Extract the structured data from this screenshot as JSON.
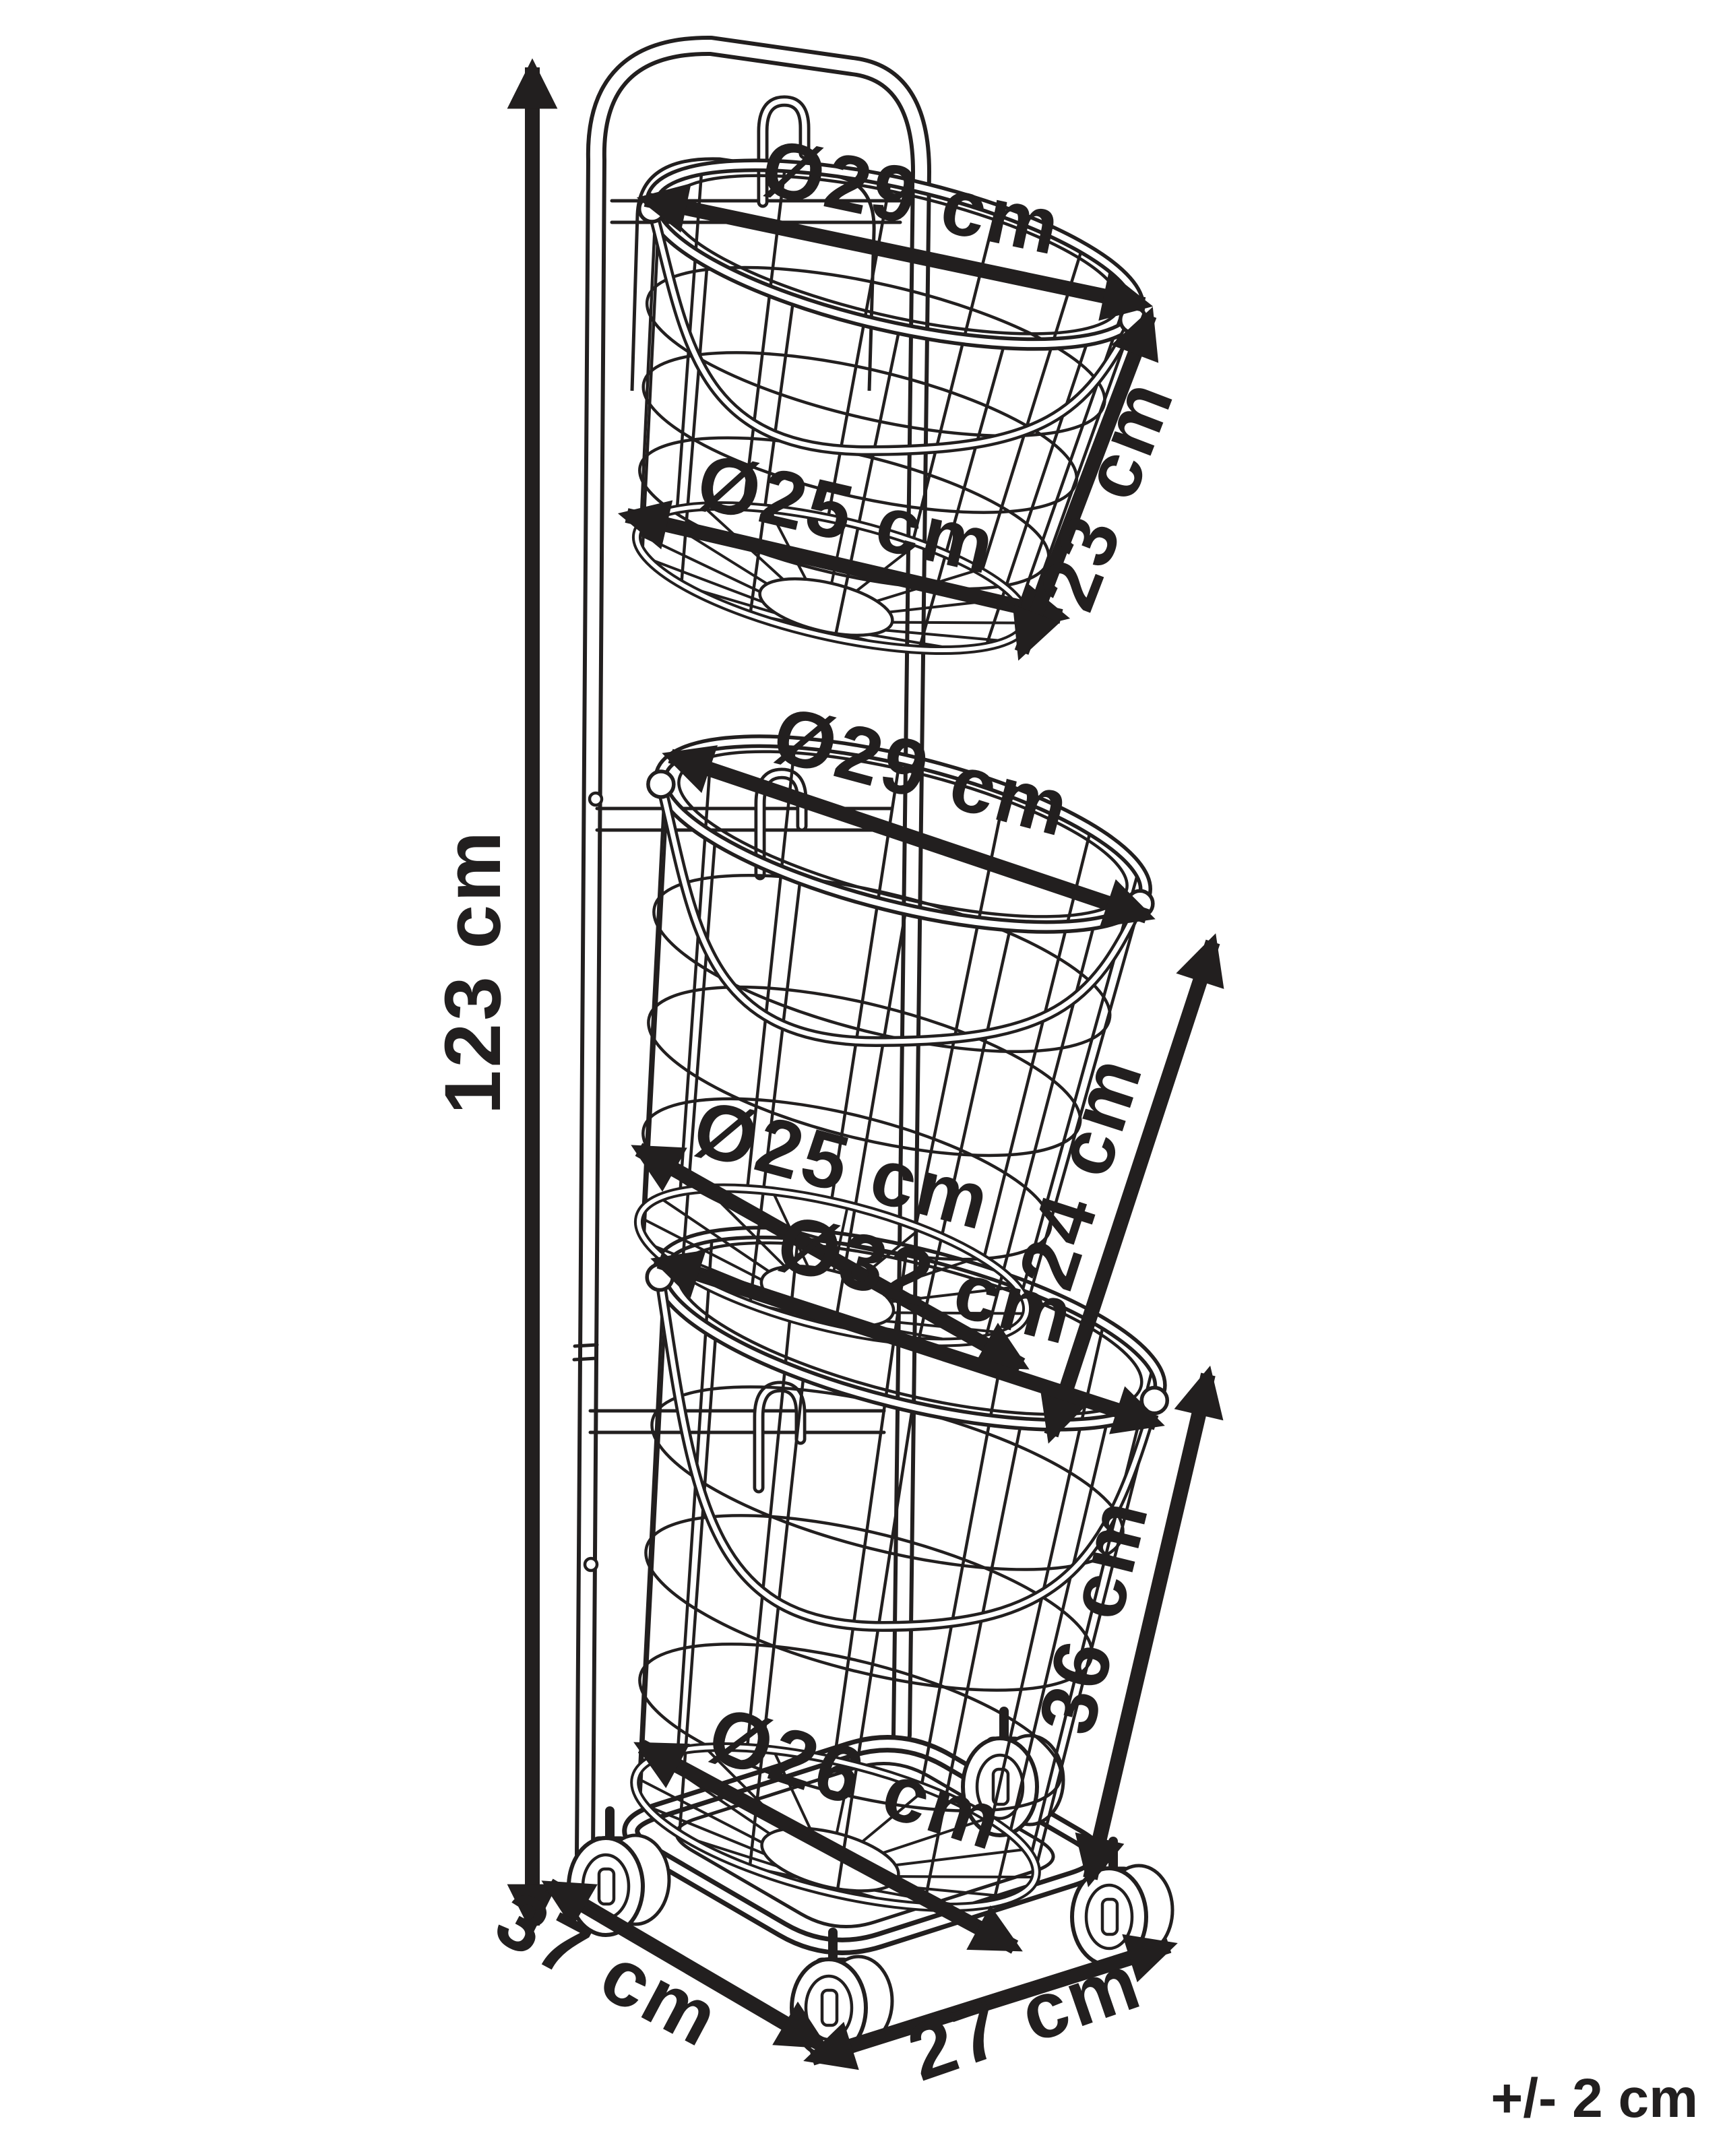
{
  "colors": {
    "background": "#ffffff",
    "ink": "#221f1f"
  },
  "labels": {
    "overall_height": "123 cm",
    "tolerance": "+/- 2 cm",
    "base": {
      "depth": "37 cm",
      "width": "27 cm"
    },
    "baskets": [
      {
        "position": "top",
        "top_diameter": "Ø29 cm",
        "bottom_diameter": "Ø25 cm",
        "height": "23 cm"
      },
      {
        "position": "middle",
        "top_diameter": "Ø29 cm",
        "bottom_diameter": "Ø25 cm",
        "height": "24 cm"
      },
      {
        "position": "bottom",
        "top_diameter": "Ø32 cm",
        "bottom_diameter": "Ø26 cm",
        "height": "36 cm"
      }
    ]
  }
}
